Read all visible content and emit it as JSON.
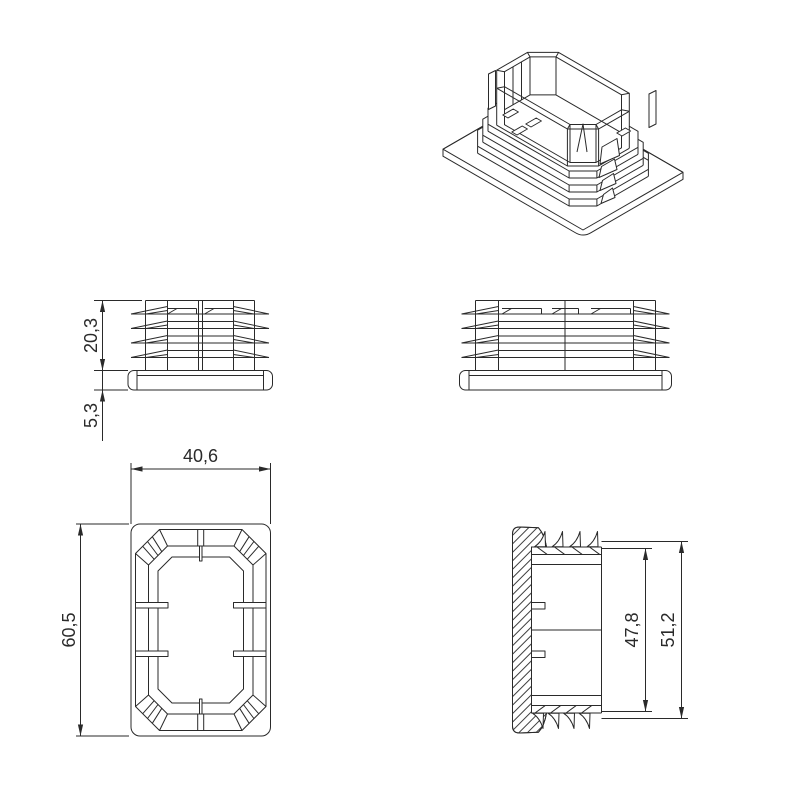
{
  "drawing": {
    "background_color": "#ffffff",
    "line_color": "#2a2a2a",
    "dimensions": {
      "side_view": {
        "insert_height": "20,3",
        "flange_height": "5,3"
      },
      "plan_view": {
        "width": "40,6",
        "length": "60,5"
      },
      "section_view": {
        "insert_depth": "47,8",
        "overall_depth": "51,2"
      }
    }
  }
}
